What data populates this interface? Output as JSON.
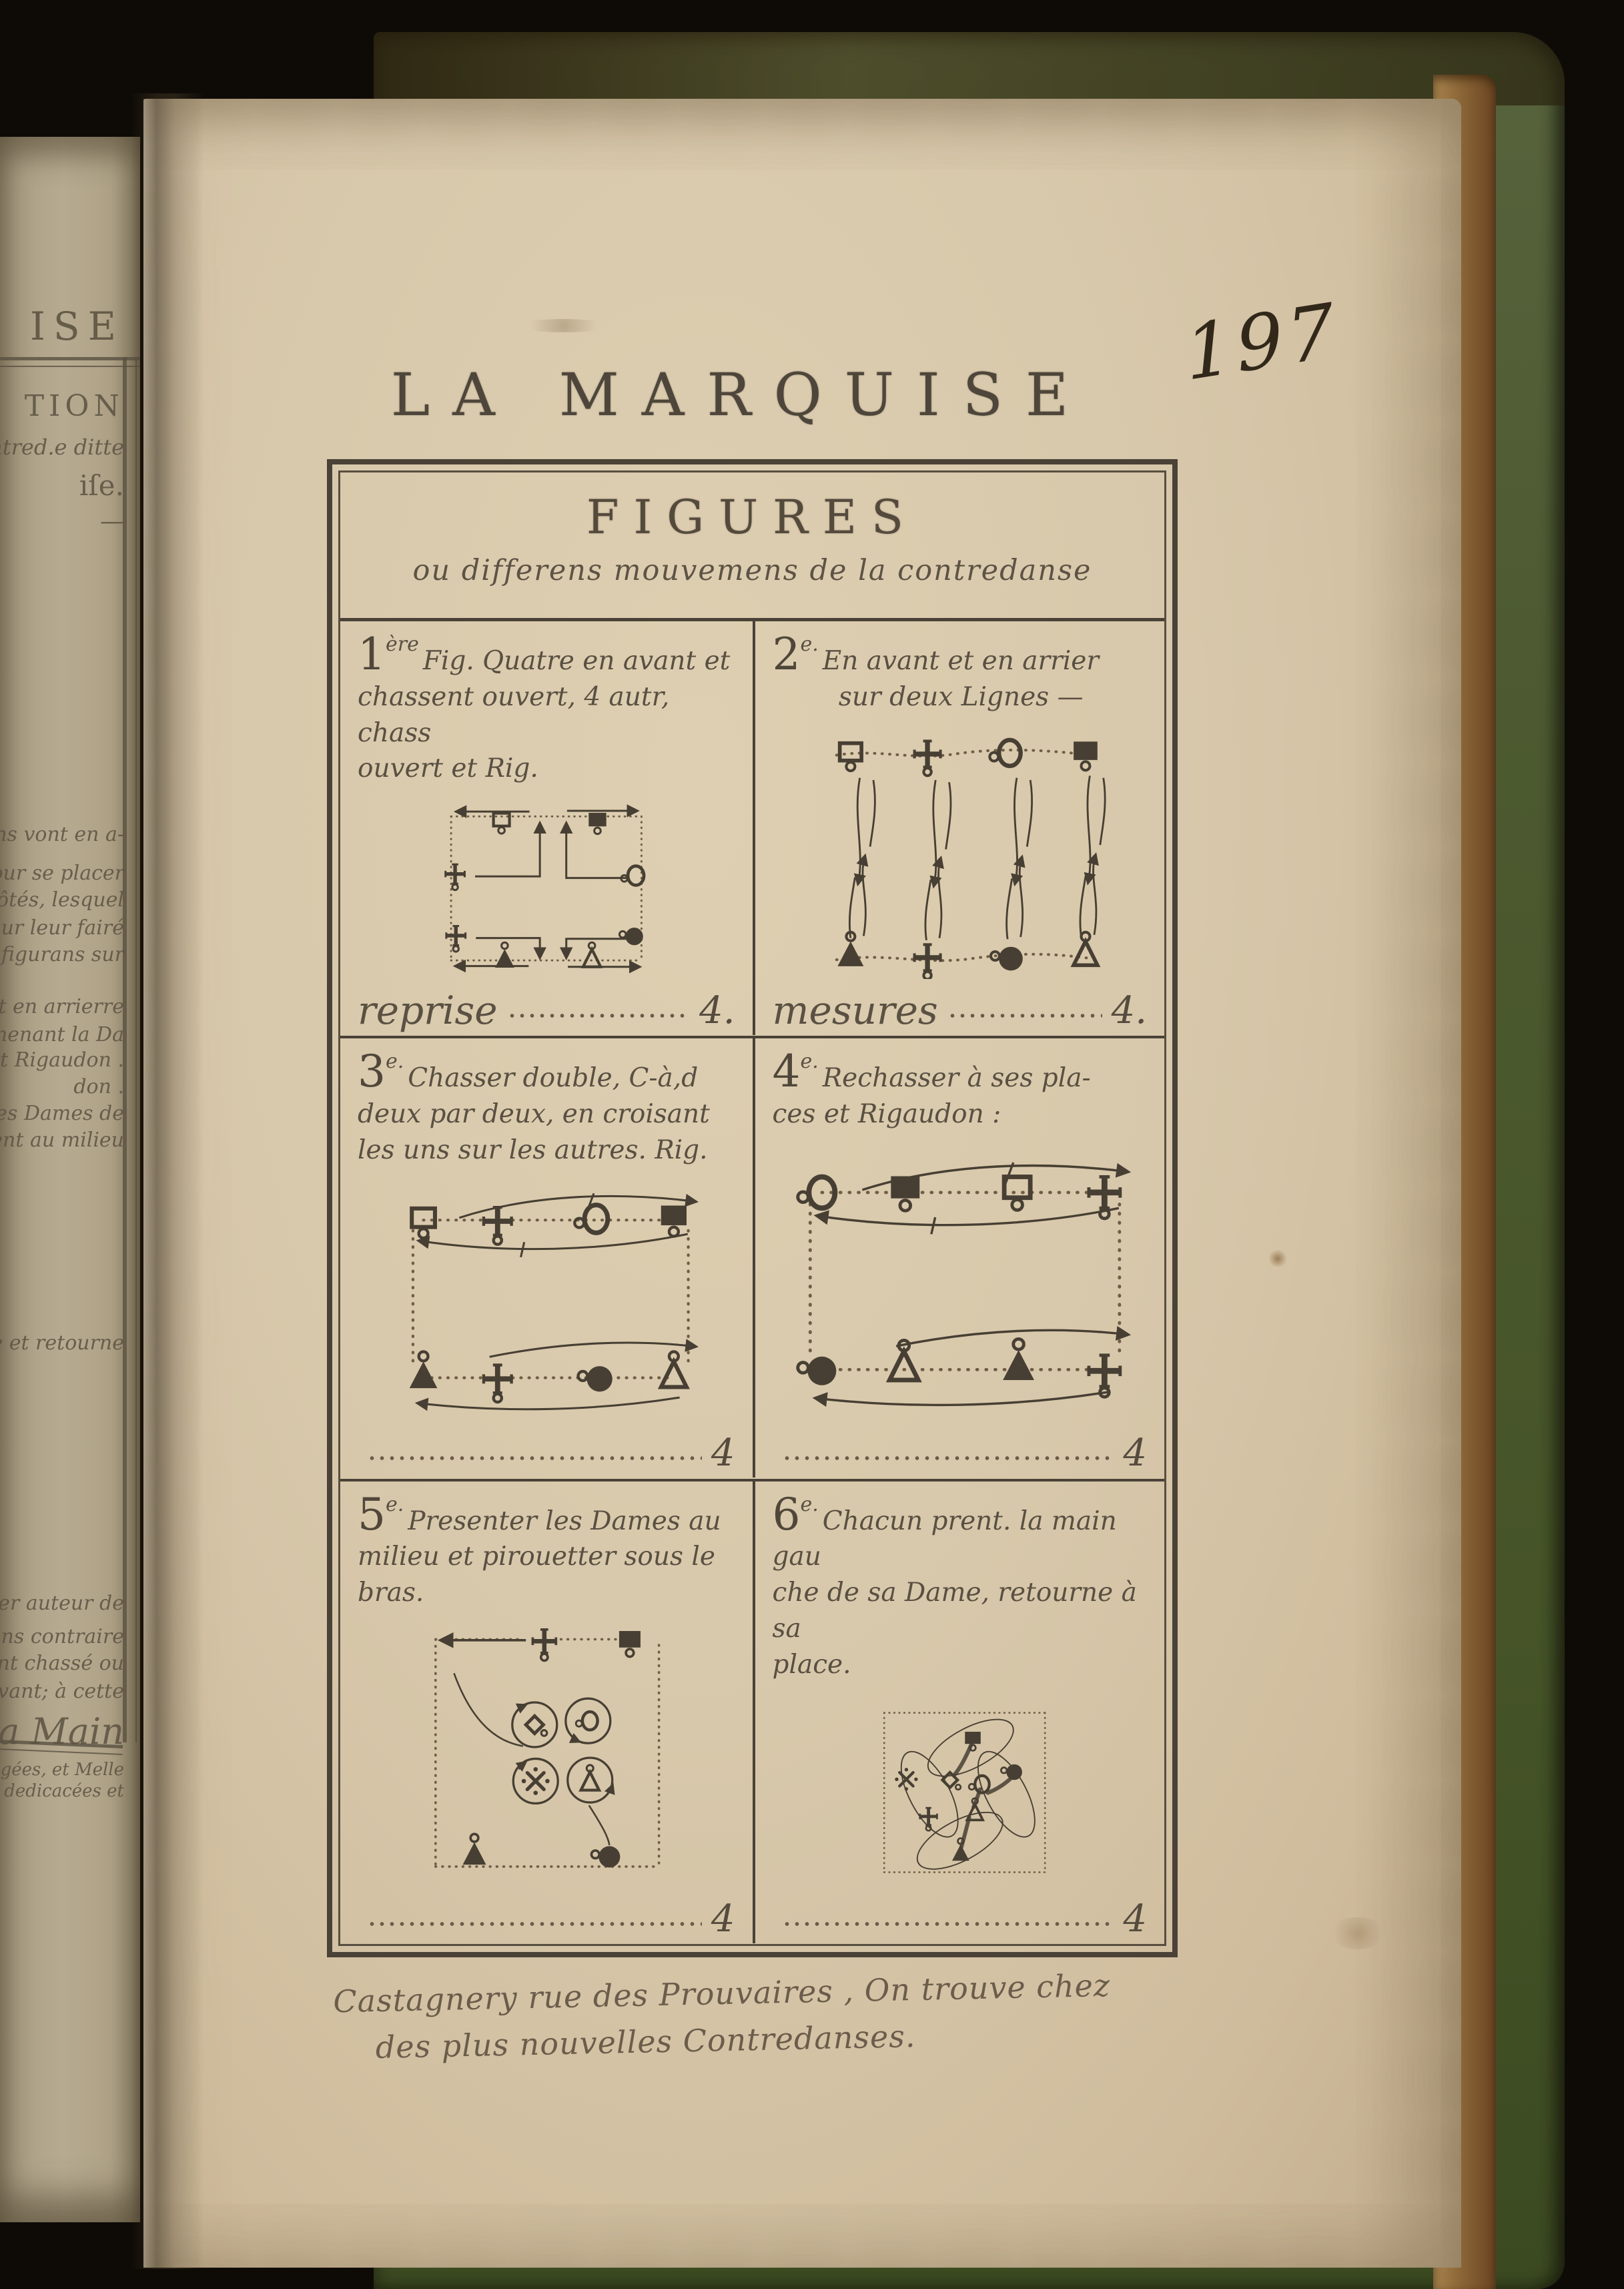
{
  "page_number": "197",
  "title": "LA MARQUISE",
  "figures_box": {
    "header": "FIGURES",
    "subtitle": "ou differens mouvemens de la contredanse",
    "panels": [
      {
        "ordinal": "1",
        "ordinal_suffix": "ère",
        "caption_lines": [
          "Fig. Quatre en avant et",
          "chassent ouvert, 4 autr, chass",
          "ouvert et Rig."
        ],
        "measure_label": "reprise",
        "measure_value": "4."
      },
      {
        "ordinal": "2",
        "ordinal_suffix": "e.",
        "caption_lines": [
          "En avant et en arrier",
          "sur deux Lignes —"
        ],
        "measure_label": "mesures",
        "measure_value": "4."
      },
      {
        "ordinal": "3",
        "ordinal_suffix": "e.",
        "caption_lines": [
          "Chasser double, C-à,d",
          "deux par deux, en croisant",
          "les uns sur les autres. Rig."
        ],
        "measure_label": "",
        "measure_value": "4"
      },
      {
        "ordinal": "4",
        "ordinal_suffix": "e.",
        "caption_lines": [
          "Rechasser à ses pla-",
          "ces et Rigaudon :"
        ],
        "measure_label": "",
        "measure_value": "4"
      },
      {
        "ordinal": "5",
        "ordinal_suffix": "e.",
        "caption_lines": [
          "Presenter les Dames au",
          "milieu et pirouetter sous le",
          "bras."
        ],
        "measure_label": "",
        "measure_value": "4"
      },
      {
        "ordinal": "6",
        "ordinal_suffix": "e.",
        "caption_lines": [
          "Chacun prent. la main gau",
          "che de sa Dame, retourne à sa",
          "place."
        ],
        "measure_label": "",
        "measure_value": "4"
      }
    ],
    "imprint_lines": [
      "Castagnery rue des Prouvaires , On trouve chez",
      "des plus nouvelles Contredanses."
    ]
  },
  "previous_page_fragments": [
    "ISE",
    "TION",
    "ontred.e ditte",
    "iſe.",
    "—",
    "ns vont en a-",
    "t pour se placer",
    "ire côtés, lesquel",
    "ur leur fairé",
    "e figurans sur",
    "t et en arrierre",
    "menant la Da",
    "et Rigaudon .",
    "don .",
    "les Dames de",
    "lent au milieu",
    "ame et retourne",
    "ner auteur de",
    "ns contraire",
    "nt chassé ou",
    "avant; à cette",
    "La Main",
    "agées, et Melle",
    "s dedicacées et"
  ],
  "colors": {
    "paper": "#d8c8ab",
    "previous_page_paper": "#b3a78d",
    "cover_green": "#4d5a31",
    "page_edge_brown": "#8a6536",
    "ink": "#473f33",
    "background": "#0e0b07"
  }
}
